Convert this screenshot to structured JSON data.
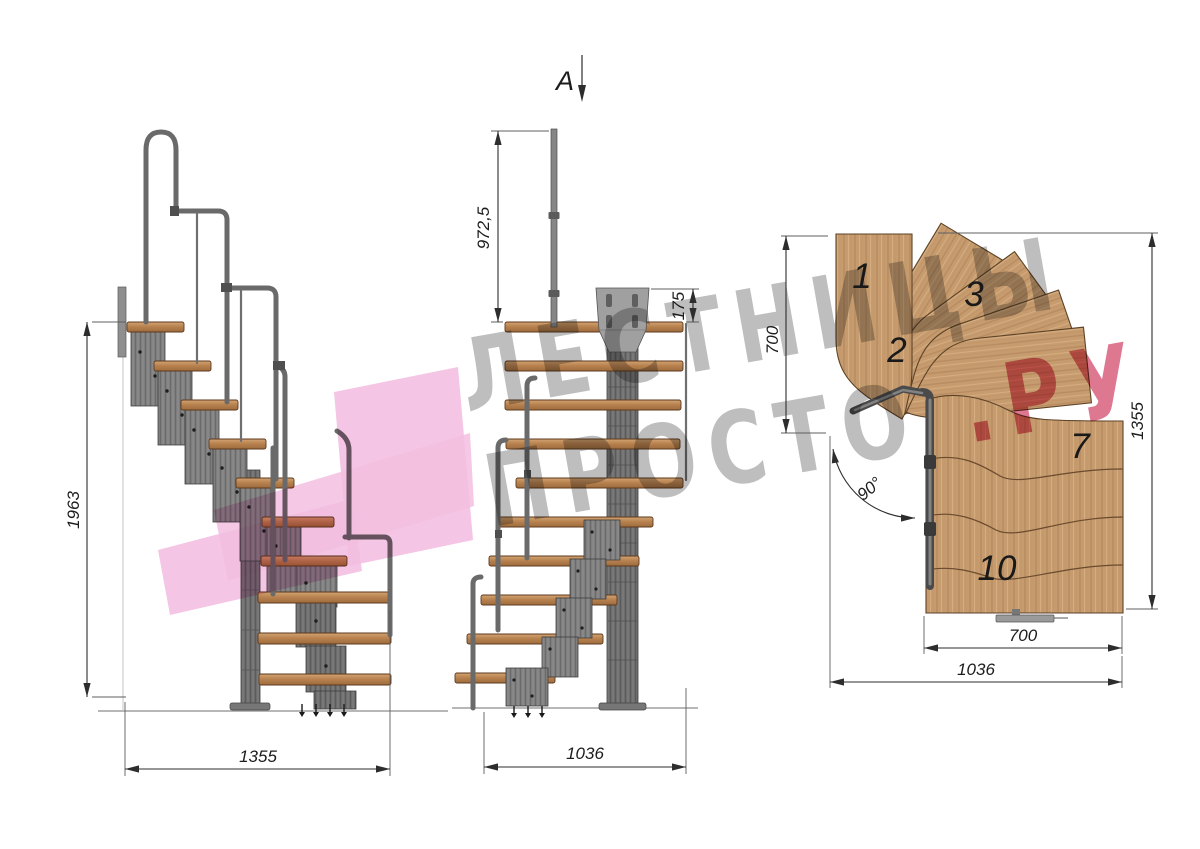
{
  "section_marker": {
    "label": "A"
  },
  "watermark": {
    "line1": "ЛЕСТНИЦЫ",
    "line2_main": "ПРОСТО",
    "line2_suffix": ".РУ"
  },
  "side_view": {
    "height_dim": "1963",
    "width_dim": "1355"
  },
  "front_view": {
    "rail_height_dim": "972,5",
    "plate_height_dim": "175",
    "width_dim": "1036"
  },
  "plan_view": {
    "left_depth_dim": "700",
    "right_height_dim": "1355",
    "tread_width_dim": "700",
    "total_width_dim": "1036",
    "angle_label": "90°",
    "tread_labels": [
      "1",
      "2",
      "3",
      "7",
      "10"
    ]
  },
  "colors": {
    "wood_light": "#d2a472",
    "wood_mid": "#c69c6f",
    "wood_dark": "#9e6b3c",
    "metal": "#7b7b7b",
    "metal_dark": "#4a4a4a",
    "dimension_line": "#2d2d2d",
    "watermark_gray": "#b3b3b3",
    "watermark_pink": "#d85f7d",
    "logo_pink": "#f3bfe1"
  }
}
